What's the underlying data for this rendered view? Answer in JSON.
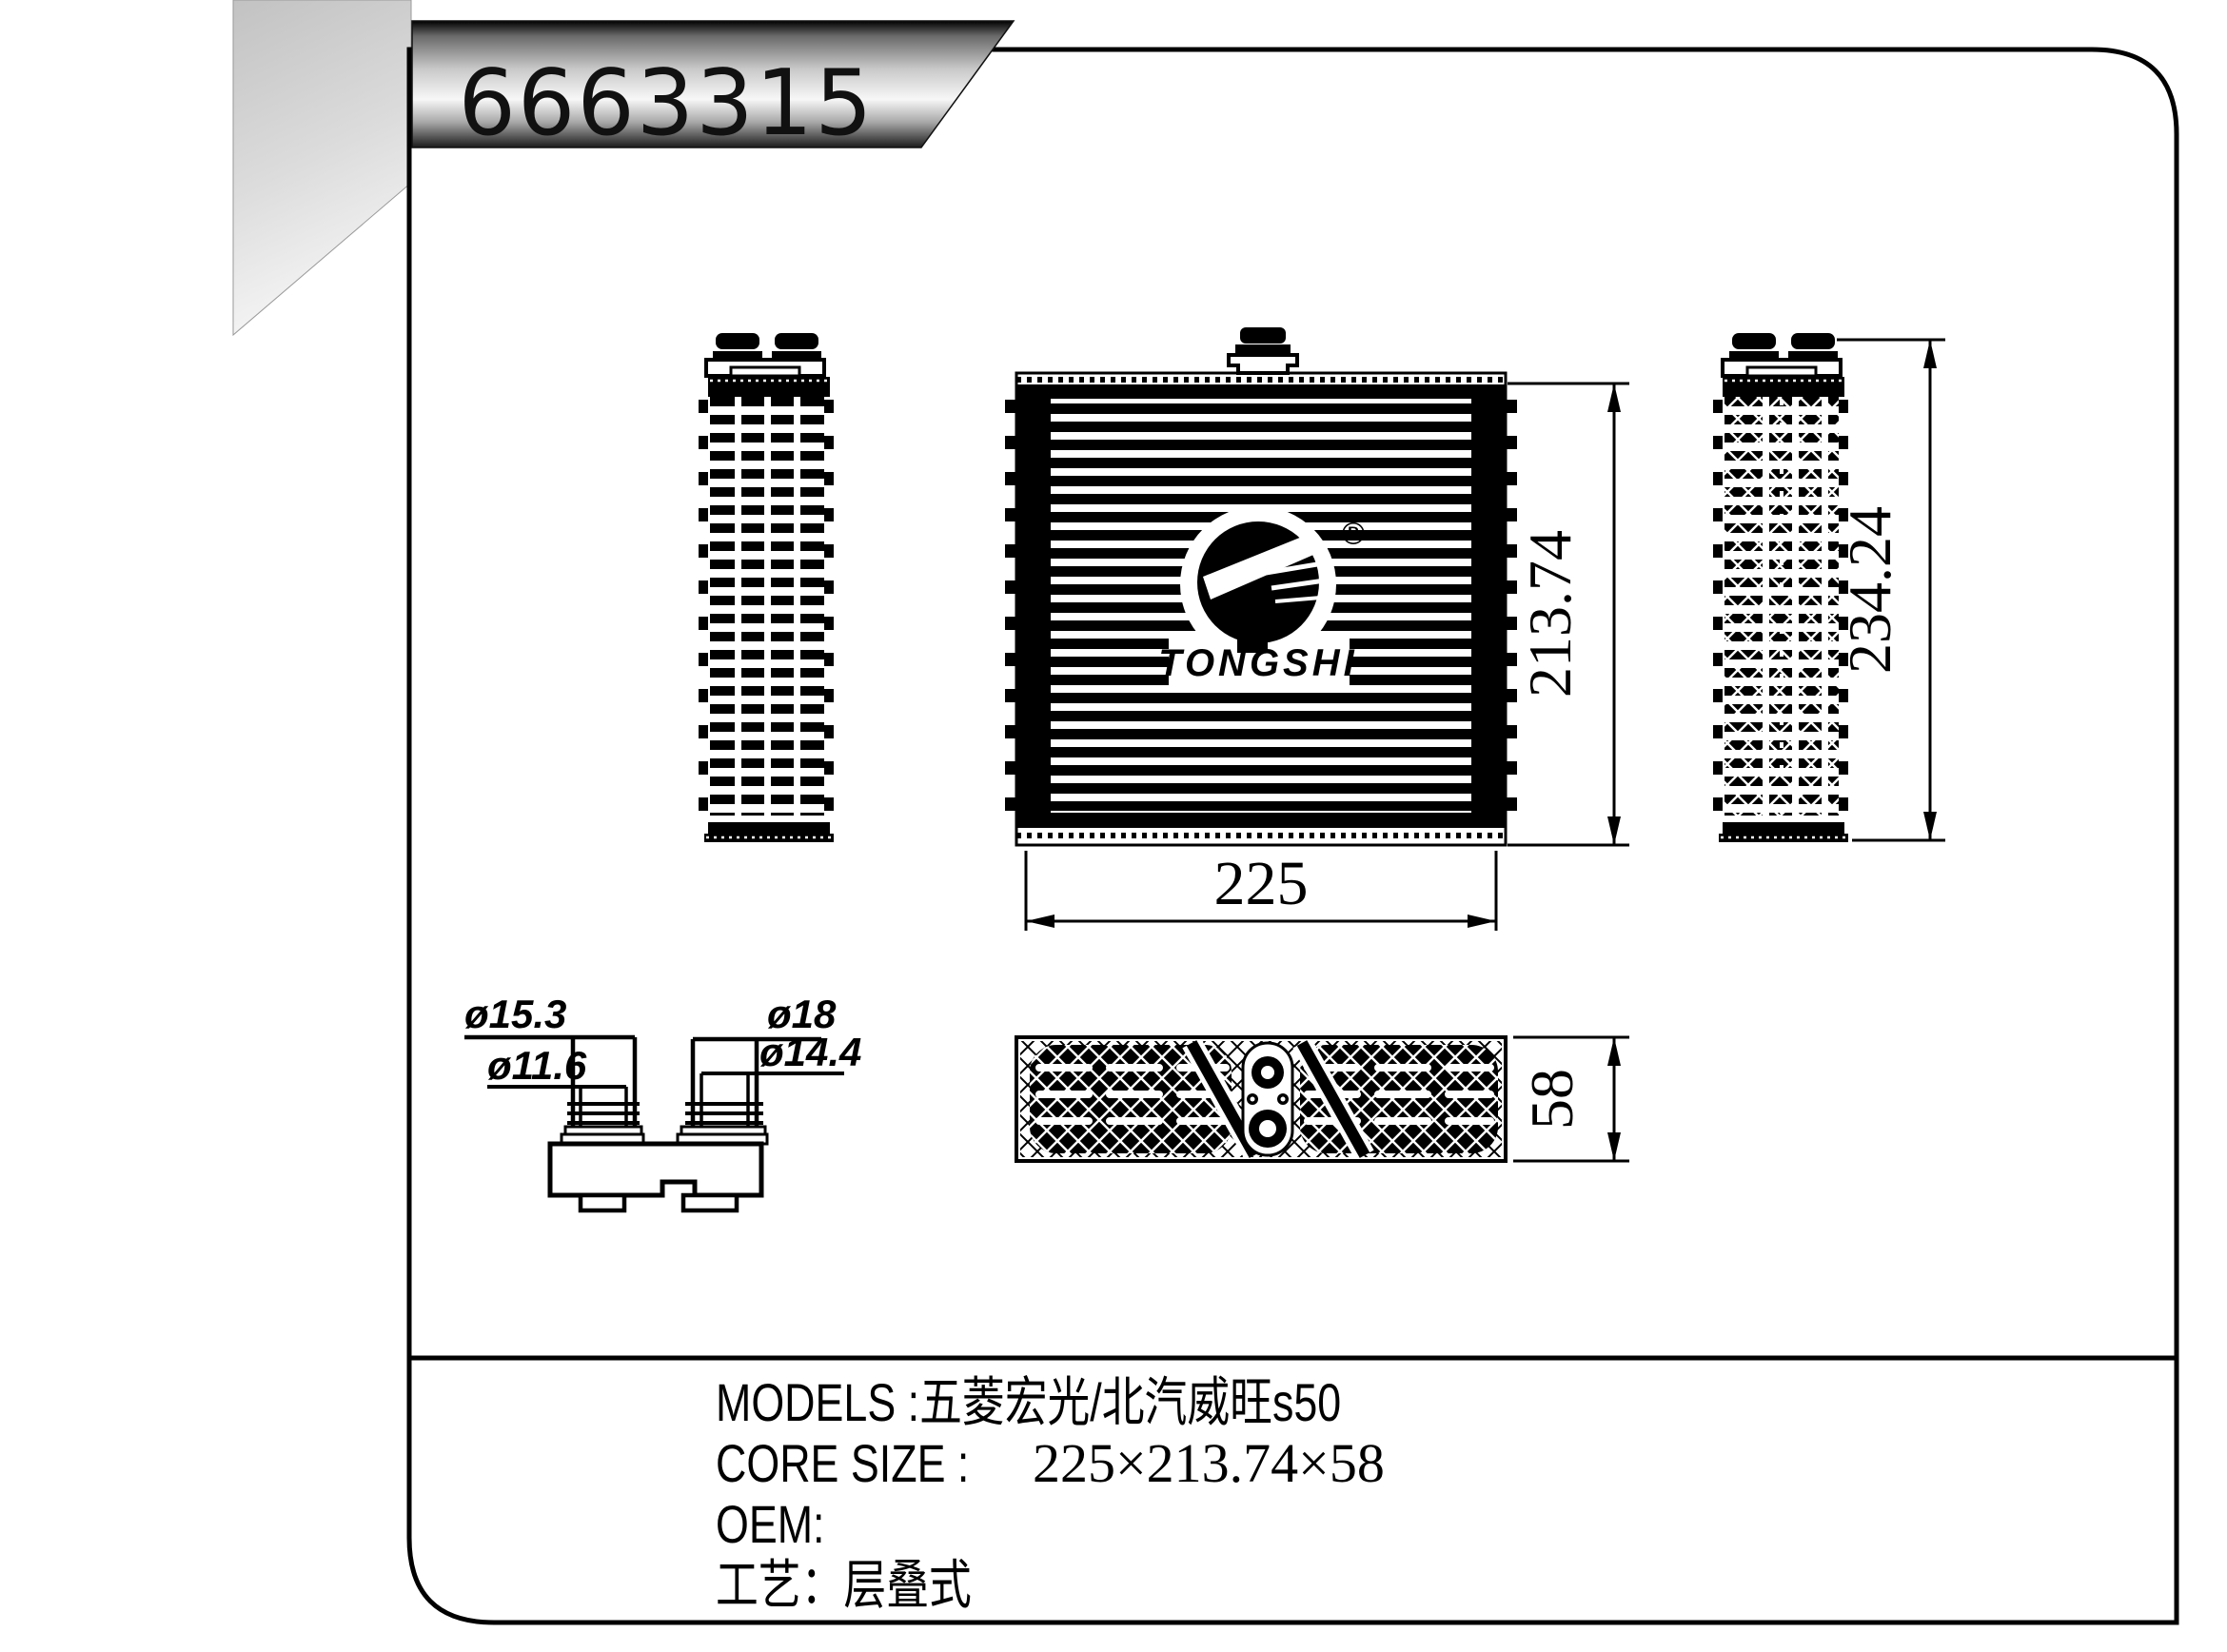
{
  "banner": {
    "part_number": "6663315"
  },
  "logo": {
    "brand": "TONGSHI",
    "registered": "®"
  },
  "dims": {
    "core_width": "225",
    "core_height": "213.74",
    "total_height": "234.24",
    "depth": "58"
  },
  "fitting": {
    "outer_left": "ø15.3",
    "inner_left": "ø11.6",
    "outer_right": "ø18",
    "inner_right": "ø14.4"
  },
  "info": {
    "models": "MODELS :五菱宏光/北汽威旺s50",
    "core_size_label": "CORE SIZE : ",
    "core_size_value": "225×213.74×58",
    "oem": "OEM:",
    "process": "工艺：层叠式"
  }
}
